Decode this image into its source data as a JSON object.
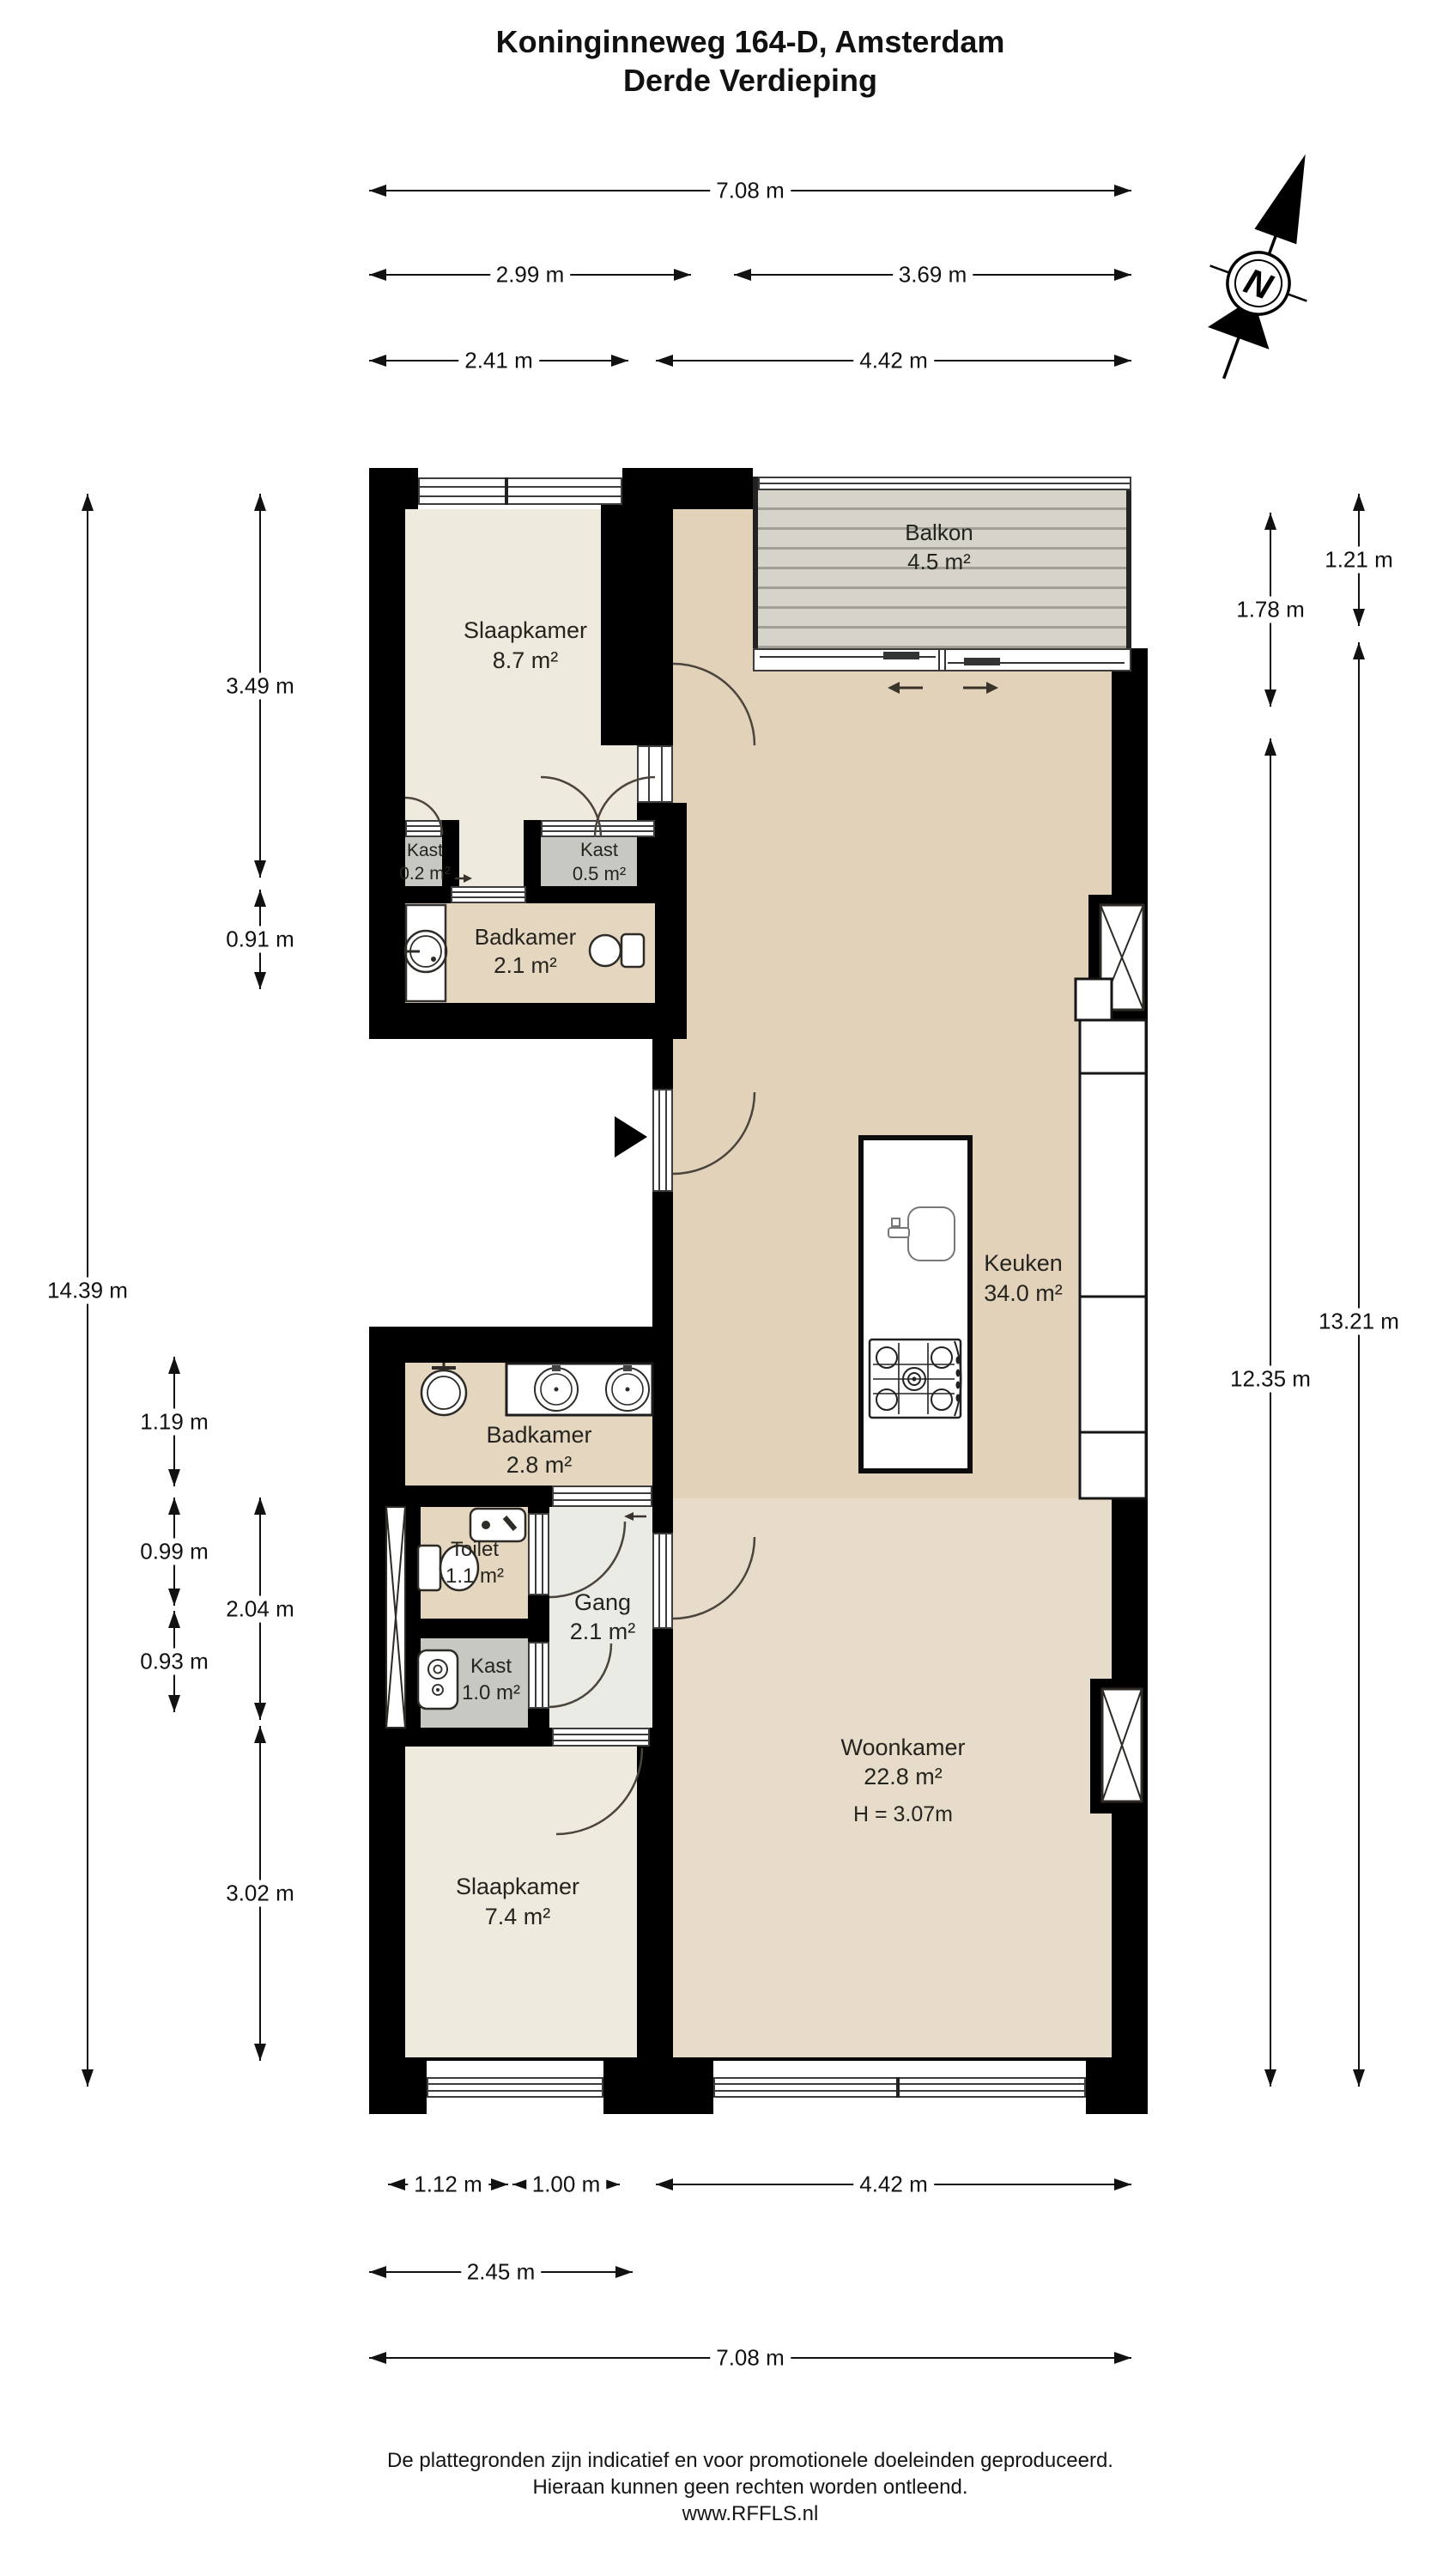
{
  "title": {
    "line1": "Koninginneweg 164-D, Amsterdam",
    "line2": "Derde Verdieping"
  },
  "compass": {
    "label": "N"
  },
  "rooms": {
    "slaapkamer1": {
      "name": "Slaapkamer",
      "area": "8.7 m²"
    },
    "balkon": {
      "name": "Balkon",
      "area": "4.5 m²"
    },
    "kast02": {
      "name": "Kast",
      "area": "0.2 m²"
    },
    "kast05": {
      "name": "Kast",
      "area": "0.5 m²"
    },
    "badkamer1": {
      "name": "Badkamer",
      "area": "2.1 m²"
    },
    "keuken": {
      "name": "Keuken",
      "area": "34.0 m²"
    },
    "badkamer2": {
      "name": "Badkamer",
      "area": "2.8 m²"
    },
    "toilet": {
      "name": "Toilet",
      "area": "1.1 m²"
    },
    "gang": {
      "name": "Gang",
      "area": "2.1 m²"
    },
    "kast10": {
      "name": "Kast",
      "area": "1.0 m²"
    },
    "woonkamer": {
      "name": "Woonkamer",
      "area": "22.8 m²",
      "ceiling": "H = 3.07m"
    },
    "slaapkamer2": {
      "name": "Slaapkamer",
      "area": "7.4 m²"
    }
  },
  "dimensions": {
    "top": {
      "full": "7.08 m",
      "left_a": "2.99 m",
      "right_a": "3.69 m",
      "left_b": "2.41 m",
      "right_b": "4.42 m"
    },
    "bottom": {
      "a": "1.12 m",
      "b": "1.00 m",
      "c": "4.42 m",
      "d": "2.45 m",
      "full": "7.08 m"
    },
    "left": {
      "a": "3.49 m",
      "b": "0.91 m",
      "full": "14.39 m",
      "c": "1.19 m",
      "d": "0.99 m",
      "e": "0.93 m",
      "f": "2.04 m",
      "g": "3.02 m"
    },
    "right": {
      "a": "1.21 m",
      "b": "1.78 m",
      "outer_full": "13.21 m",
      "inner_full": "12.35 m"
    }
  },
  "footer": {
    "line1": "De plattegronden zijn indicatief en voor promotionele doeleinden geproduceerd.",
    "line2": "Hieraan kunnen geen rechten worden ontleend.",
    "line3": "www.RFFLS.nl"
  },
  "colors": {
    "wall": "#000000",
    "bedroom_floor": "#eeeade",
    "kitchen_floor": "#e1d2b9",
    "living_floor": "#e6dcc9",
    "bathroom_floor": "#e5d6bf",
    "closet_floor": "#c7c8c1",
    "hall_floor": "#ebebe5",
    "balcony_deck": "#d6d3ca",
    "dimension_line": "#111111"
  }
}
